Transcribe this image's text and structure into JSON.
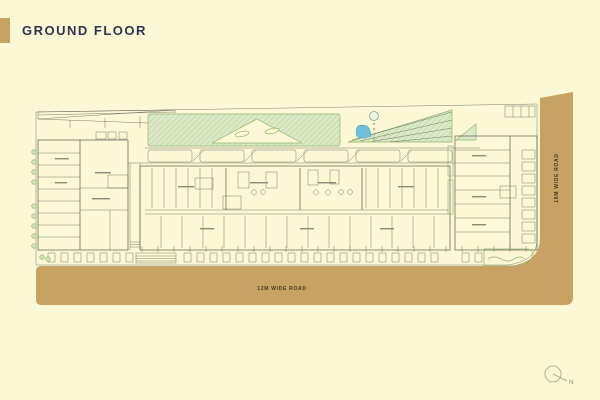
{
  "header": {
    "title": "GROUND FLOOR"
  },
  "plan": {
    "roads": {
      "bottom_label": "12M WIDE ROAD",
      "right_label": "18M WIDE ROAD"
    },
    "north": {
      "label": "N"
    }
  },
  "colors": {
    "background": "#FCF8D5",
    "accent": "#C8A263",
    "road": "#C8A263",
    "title": "#2B3550",
    "plan_line": "#5C5C4E",
    "lawn": "#DCE9C6",
    "lawn_stroke": "#8FB56C",
    "pool": "#72BFDC",
    "road_label": "#45381C",
    "north": "#9A9077"
  }
}
